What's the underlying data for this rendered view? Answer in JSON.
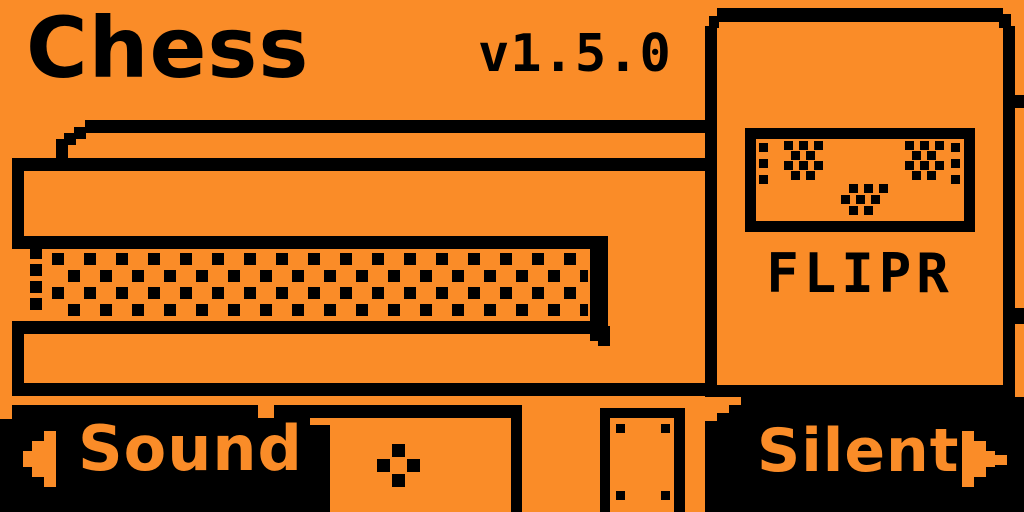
{
  "app": {
    "title": "Chess",
    "version": "v1.5.0"
  },
  "illustration": {
    "name": "chessboard-side-view",
    "texture": "dotted-band"
  },
  "opponent_card": {
    "name": "FLIPR",
    "face_icon": "flipr-face-icon"
  },
  "bottom_bar": {
    "left_button": {
      "label": "Sound",
      "icon": "left-arrow-icon"
    },
    "center_button": {
      "icon": "ok-diamond-icon"
    },
    "right_button": {
      "label": "Silent",
      "icon": "right-arrow-icon"
    }
  },
  "colors": {
    "background": "#FA8C28",
    "ink": "#000000"
  }
}
